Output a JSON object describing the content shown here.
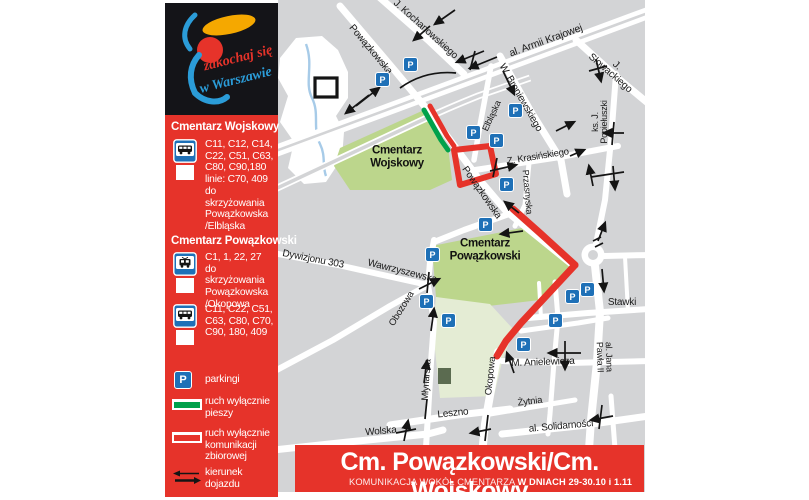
{
  "colors": {
    "accent_red": "#e6332a",
    "route_green": "#00a14b",
    "parking_blue": "#1e70b7",
    "map_background": "#d3d4d6",
    "cemetery_green": "#bcd68c",
    "cemetery_pale_green": "#e4ecd4",
    "stream_blue": "#a7cbe8"
  },
  "logo": {
    "script_line1": "zakochaj się",
    "script_line2": "w Warszawie"
  },
  "sidebar": {
    "sections": [
      {
        "title": "Cmentarz Wojskowy",
        "items": [
          {
            "icon": "bus-stop-sign",
            "lines": "C11, C12, C14,\nC22, C51, C63,\nC80, C90,180\nlinie: C70, 409\ndo skrzyżowania\nPowązkowska\n/Elbląska"
          }
        ]
      },
      {
        "title": "Cmentarz Powązkowski",
        "items": [
          {
            "icon": "tram-stop-sign",
            "lines": "C1, 1, 22, 27\ndo skrzyżowania\nPowązkowska\n/Okopowa"
          },
          {
            "icon": "bus-stop-sign",
            "lines": "C11, C22, C51,\nC63, C80, C70,\nC90, 180, 409"
          }
        ]
      }
    ],
    "legend": [
      {
        "icon": "parking-sign",
        "label": "parkingi"
      },
      {
        "icon": "green-line",
        "label": "ruch wyłącznie\npieszy"
      },
      {
        "icon": "red-line",
        "label": "ruch wyłącznie\nkomunikacji\nzbiorowej"
      },
      {
        "icon": "direction-arrows",
        "label": "kierunek\ndojazdu"
      }
    ]
  },
  "map": {
    "parking_letter": "P",
    "street_labels": [
      {
        "t": "Powązkowska",
        "x": 92,
        "y": 50,
        "r": 50,
        "s": 10
      },
      {
        "t": "J. Kochanowskiego",
        "x": 147,
        "y": 30,
        "r": 42,
        "s": 10
      },
      {
        "t": "al. Armii Krajowej",
        "x": 268,
        "y": 41,
        "r": -20,
        "s": 10.5
      },
      {
        "t": "J. Słowackiego",
        "x": 335,
        "y": 70,
        "r": 41,
        "s": 10
      },
      {
        "t": "W. Broniewskiego",
        "x": 242,
        "y": 98,
        "r": 60,
        "s": 10
      },
      {
        "t": "ks. J.\nPopiełuszki",
        "x": 322,
        "y": 122,
        "r": -90,
        "s": 9
      },
      {
        "t": "Elbląska",
        "x": 214,
        "y": 116,
        "r": -65,
        "s": 9
      },
      {
        "t": "Z. Krasińskiego",
        "x": 260,
        "y": 157,
        "r": -9,
        "s": 9.5
      },
      {
        "t": "Przasnyska",
        "x": 249,
        "y": 192,
        "r": 85,
        "s": 9
      },
      {
        "t": "Powązkowska",
        "x": 203,
        "y": 193,
        "r": 55,
        "s": 10
      },
      {
        "t": "Dywizjonu 303",
        "x": 35,
        "y": 260,
        "r": 11,
        "s": 10
      },
      {
        "t": "Wawrzyszewska",
        "x": 124,
        "y": 272,
        "r": 14,
        "s": 10
      },
      {
        "t": "Obozowa",
        "x": 124,
        "y": 309,
        "r": -58,
        "s": 9.5
      },
      {
        "t": "Młynarska",
        "x": 149,
        "y": 380,
        "r": -86,
        "s": 9.5
      },
      {
        "t": "Okopowa",
        "x": 213,
        "y": 376,
        "r": -84,
        "s": 9.5
      },
      {
        "t": "Leszno",
        "x": 175,
        "y": 414,
        "r": -6,
        "s": 10
      },
      {
        "t": "Wolska",
        "x": 103,
        "y": 432,
        "r": -5,
        "s": 10
      },
      {
        "t": "Żytnia",
        "x": 252,
        "y": 402,
        "r": -7,
        "s": 9.5
      },
      {
        "t": "al. Solidarności",
        "x": 283,
        "y": 427,
        "r": -5,
        "s": 10
      },
      {
        "t": "M. Anielewicza",
        "x": 265,
        "y": 363,
        "r": -2,
        "s": 10
      },
      {
        "t": "Stawki",
        "x": 344,
        "y": 303,
        "r": 0,
        "s": 10
      },
      {
        "t": "al. Jana Pawła II",
        "x": 326,
        "y": 357,
        "r": 88,
        "s": 9
      }
    ],
    "area_labels": [
      {
        "t": "Cmentarz\nWojskowy",
        "x": 119,
        "y": 157
      },
      {
        "t": "Cmentarz\nPowązkowski",
        "x": 207,
        "y": 250
      }
    ],
    "parkings": [
      [
        125,
        57
      ],
      [
        97,
        72
      ],
      [
        230,
        103
      ],
      [
        188,
        125
      ],
      [
        211,
        133
      ],
      [
        221,
        177
      ],
      [
        200,
        217
      ],
      [
        147,
        247
      ],
      [
        141,
        294
      ],
      [
        163,
        313
      ],
      [
        238,
        337
      ],
      [
        270,
        313
      ],
      [
        287,
        289
      ],
      [
        302,
        282
      ]
    ]
  },
  "banner": {
    "title": "Cm. Powązkowski/Cm. Wojskowy",
    "subtitle_regular": "KOMUNIKACJA WOKÓŁ CMENTARZA ",
    "subtitle_bold": "W DNIACH 29-30.10 i 1.11"
  }
}
